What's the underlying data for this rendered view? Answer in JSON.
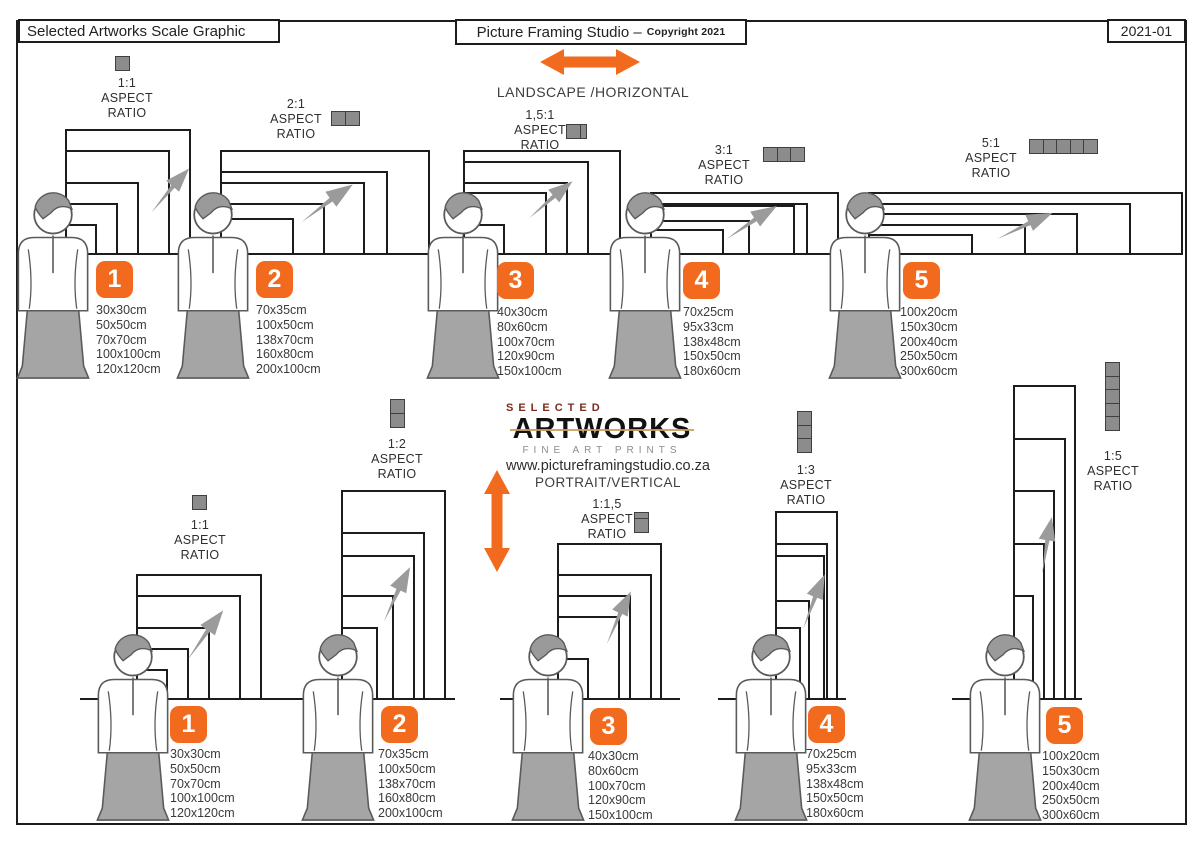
{
  "header": {
    "left_title": "Selected Artworks Scale Graphic",
    "center_title": "Picture Framing Studio –",
    "center_copyright": "Copyright 2021",
    "right_code": "2021-01"
  },
  "sections": {
    "landscape": {
      "label": "LANDSCAPE /HORIZONTAL"
    },
    "portrait": {
      "label": "PORTRAIT/VERTICAL"
    }
  },
  "logo": {
    "top": "SELECTED",
    "main": "ARTWORKS",
    "sub": "FINE ART PRINTS",
    "website": "www.pictureframingstudio.co.za"
  },
  "colors": {
    "accent": "#F26A1E",
    "frame": "#1c1c1c",
    "person_fill": "#a5a5a5",
    "icon_fill": "#8c8c8c",
    "arrow_gray": "#9b9b9b",
    "logo_red": "#7b2c1e"
  },
  "scale_px_per_cm": 1.05,
  "rails": [
    {
      "x": 65,
      "y": 255,
      "w": 1118
    },
    {
      "x": 80,
      "y": 700,
      "w": 212
    },
    {
      "x": 290,
      "y": 700,
      "w": 165
    },
    {
      "x": 500,
      "y": 700,
      "w": 180
    },
    {
      "x": 718,
      "y": 700,
      "w": 128
    },
    {
      "x": 952,
      "y": 700,
      "w": 130
    }
  ],
  "groups": [
    {
      "id": "landscape-1",
      "section": "landscape",
      "number": "1",
      "ratio_lines": [
        "1:1",
        "ASPECT",
        "RATIO"
      ],
      "sizes": [
        "30x30cm",
        "50x50cm",
        "70x70cm",
        "100x100cm",
        "120x120cm"
      ],
      "icon": {
        "dir": "h",
        "cells": [
          1
        ]
      },
      "layout": {
        "anchor_x": 65,
        "rail_y": 255,
        "label_cx": 127,
        "label_y": 76,
        "icon_x": 115,
        "icon_y": 56,
        "badge_x": 96,
        "badge_y": 261,
        "list_x": 96,
        "list_y": 303,
        "person_x": 8,
        "person_y": 192,
        "arrow": {
          "cx": 168,
          "cy": 188,
          "rot": -41,
          "len": 60
        }
      }
    },
    {
      "id": "landscape-2",
      "section": "landscape",
      "number": "2",
      "ratio_lines": [
        "2:1",
        "ASPECT",
        "RATIO"
      ],
      "sizes": [
        "70x35cm",
        "100x50cm",
        "138x70cm",
        "160x80cm",
        "200x100cm"
      ],
      "icon": {
        "dir": "h",
        "cells": [
          1,
          1
        ]
      },
      "layout": {
        "anchor_x": 220,
        "rail_y": 255,
        "label_cx": 296,
        "label_y": 97,
        "icon_x": 331,
        "icon_y": 111,
        "badge_x": 256,
        "badge_y": 261,
        "list_x": 256,
        "list_y": 303,
        "person_x": 168,
        "person_y": 192,
        "arrow": {
          "cx": 325,
          "cy": 200,
          "rot": -28,
          "len": 65
        }
      }
    },
    {
      "id": "landscape-3",
      "section": "landscape",
      "number": "3",
      "ratio_lines": [
        "1,5:1",
        "ASPECT",
        "RATIO"
      ],
      "sizes": [
        "40x30cm",
        "80x60cm",
        "100x70cm",
        "120x90cm",
        "150x100cm"
      ],
      "icon": {
        "dir": "h",
        "cells": [
          1,
          0.5
        ]
      },
      "layout": {
        "anchor_x": 463,
        "rail_y": 255,
        "label_cx": 540,
        "label_y": 108,
        "icon_x": 566,
        "icon_y": 124,
        "badge_x": 497,
        "badge_y": 262,
        "list_x": 497,
        "list_y": 305,
        "person_x": 418,
        "person_y": 192,
        "arrow": {
          "cx": 549,
          "cy": 197,
          "rot": -32,
          "len": 58
        }
      }
    },
    {
      "id": "landscape-4",
      "section": "landscape",
      "number": "4",
      "ratio_lines": [
        "3:1",
        "ASPECT",
        "RATIO"
      ],
      "sizes": [
        "70x25cm",
        "95x33cm",
        "138x48cm",
        "150x50cm",
        "180x60cm"
      ],
      "icon": {
        "dir": "h",
        "cells": [
          1,
          1,
          1
        ]
      },
      "layout": {
        "anchor_x": 650,
        "rail_y": 255,
        "label_cx": 724,
        "label_y": 143,
        "icon_x": 763,
        "icon_y": 147,
        "badge_x": 683,
        "badge_y": 262,
        "list_x": 683,
        "list_y": 305,
        "person_x": 600,
        "person_y": 192,
        "arrow": {
          "cx": 750,
          "cy": 219,
          "rot": -25,
          "len": 62
        }
      }
    },
    {
      "id": "landscape-5",
      "section": "landscape",
      "number": "5",
      "ratio_lines": [
        "5:1",
        "ASPECT",
        "RATIO"
      ],
      "sizes": [
        "100x20cm",
        "150x30cm",
        "200x40cm",
        "250x50cm",
        "300x60cm"
      ],
      "icon": {
        "dir": "h",
        "cells": [
          1,
          1,
          1,
          1,
          1
        ]
      },
      "layout": {
        "anchor_x": 868,
        "rail_y": 255,
        "label_cx": 991,
        "label_y": 136,
        "icon_x": 1029,
        "icon_y": 139,
        "badge_x": 903,
        "badge_y": 262,
        "list_x": 900,
        "list_y": 305,
        "person_x": 820,
        "person_y": 192,
        "arrow": {
          "cx": 1024,
          "cy": 222,
          "rot": -17,
          "len": 62
        }
      }
    },
    {
      "id": "portrait-1",
      "section": "portrait",
      "number": "1",
      "ratio_lines": [
        "1:1",
        "ASPECT",
        "RATIO"
      ],
      "sizes": [
        "30x30cm",
        "50x50cm",
        "70x70cm",
        "100x100cm",
        "120x120cm"
      ],
      "icon": {
        "dir": "v",
        "cells": [
          1
        ]
      },
      "layout": {
        "anchor_x": 136,
        "rail_y": 700,
        "label_cx": 200,
        "label_y": 518,
        "icon_x": 192,
        "icon_y": 495,
        "badge_x": 170,
        "badge_y": 706,
        "list_x": 170,
        "list_y": 747,
        "person_x": 88,
        "person_y": 634,
        "arrow": {
          "cx": 203,
          "cy": 632,
          "rot": -46,
          "len": 62
        }
      }
    },
    {
      "id": "portrait-2",
      "section": "portrait",
      "number": "2",
      "ratio_lines": [
        "1:2",
        "ASPECT",
        "RATIO"
      ],
      "sizes": [
        "70x35cm",
        "100x50cm",
        "138x70cm",
        "160x80cm",
        "200x100cm"
      ],
      "icon": {
        "dir": "v",
        "cells": [
          1,
          1
        ]
      },
      "layout": {
        "anchor_x": 341,
        "rail_y": 700,
        "label_cx": 397,
        "label_y": 437,
        "icon_x": 390,
        "icon_y": 399,
        "badge_x": 381,
        "badge_y": 706,
        "list_x": 378,
        "list_y": 747,
        "person_x": 293,
        "person_y": 634,
        "arrow": {
          "cx": 394,
          "cy": 592,
          "rot": -56,
          "len": 62
        }
      }
    },
    {
      "id": "portrait-3",
      "section": "portrait",
      "number": "3",
      "ratio_lines": [
        "1:1,5",
        "ASPECT",
        "RATIO"
      ],
      "sizes": [
        "40x30cm",
        "80x60cm",
        "100x70cm",
        "120x90cm",
        "150x100cm"
      ],
      "icon": {
        "dir": "v",
        "cells": [
          0.5,
          1
        ]
      },
      "layout": {
        "anchor_x": 557,
        "rail_y": 700,
        "label_cx": 607,
        "label_y": 497,
        "icon_x": 634,
        "icon_y": 512,
        "badge_x": 590,
        "badge_y": 708,
        "list_x": 588,
        "list_y": 749,
        "person_x": 503,
        "person_y": 634,
        "arrow": {
          "cx": 616,
          "cy": 616,
          "rot": -57,
          "len": 60
        }
      }
    },
    {
      "id": "portrait-4",
      "section": "portrait",
      "number": "4",
      "ratio_lines": [
        "1:3",
        "ASPECT",
        "RATIO"
      ],
      "sizes": [
        "70x25cm",
        "95x33cm",
        "138x48cm",
        "150x50cm",
        "180x60cm"
      ],
      "icon": {
        "dir": "v",
        "cells": [
          1,
          1,
          1
        ]
      },
      "layout": {
        "anchor_x": 775,
        "rail_y": 700,
        "label_cx": 806,
        "label_y": 463,
        "icon_x": 797,
        "icon_y": 411,
        "badge_x": 808,
        "badge_y": 706,
        "list_x": 806,
        "list_y": 747,
        "person_x": 726,
        "person_y": 634,
        "arrow": {
          "cx": 811,
          "cy": 600,
          "rot": -60,
          "len": 60
        }
      }
    },
    {
      "id": "portrait-5",
      "section": "portrait",
      "number": "5",
      "ratio_lines": [
        "1:5",
        "ASPECT",
        "RATIO"
      ],
      "sizes": [
        "100x20cm",
        "150x30cm",
        "200x40cm",
        "250x50cm",
        "300x60cm"
      ],
      "icon": {
        "dir": "v",
        "cells": [
          1,
          1,
          1,
          1,
          1
        ]
      },
      "layout": {
        "anchor_x": 1013,
        "rail_y": 700,
        "label_cx": 1113,
        "label_y": 449,
        "icon_x": 1105,
        "icon_y": 362,
        "badge_x": 1046,
        "badge_y": 707,
        "list_x": 1042,
        "list_y": 749,
        "person_x": 960,
        "person_y": 634,
        "arrow": {
          "cx": 1044,
          "cy": 544,
          "rot": -72,
          "len": 58
        }
      }
    }
  ]
}
